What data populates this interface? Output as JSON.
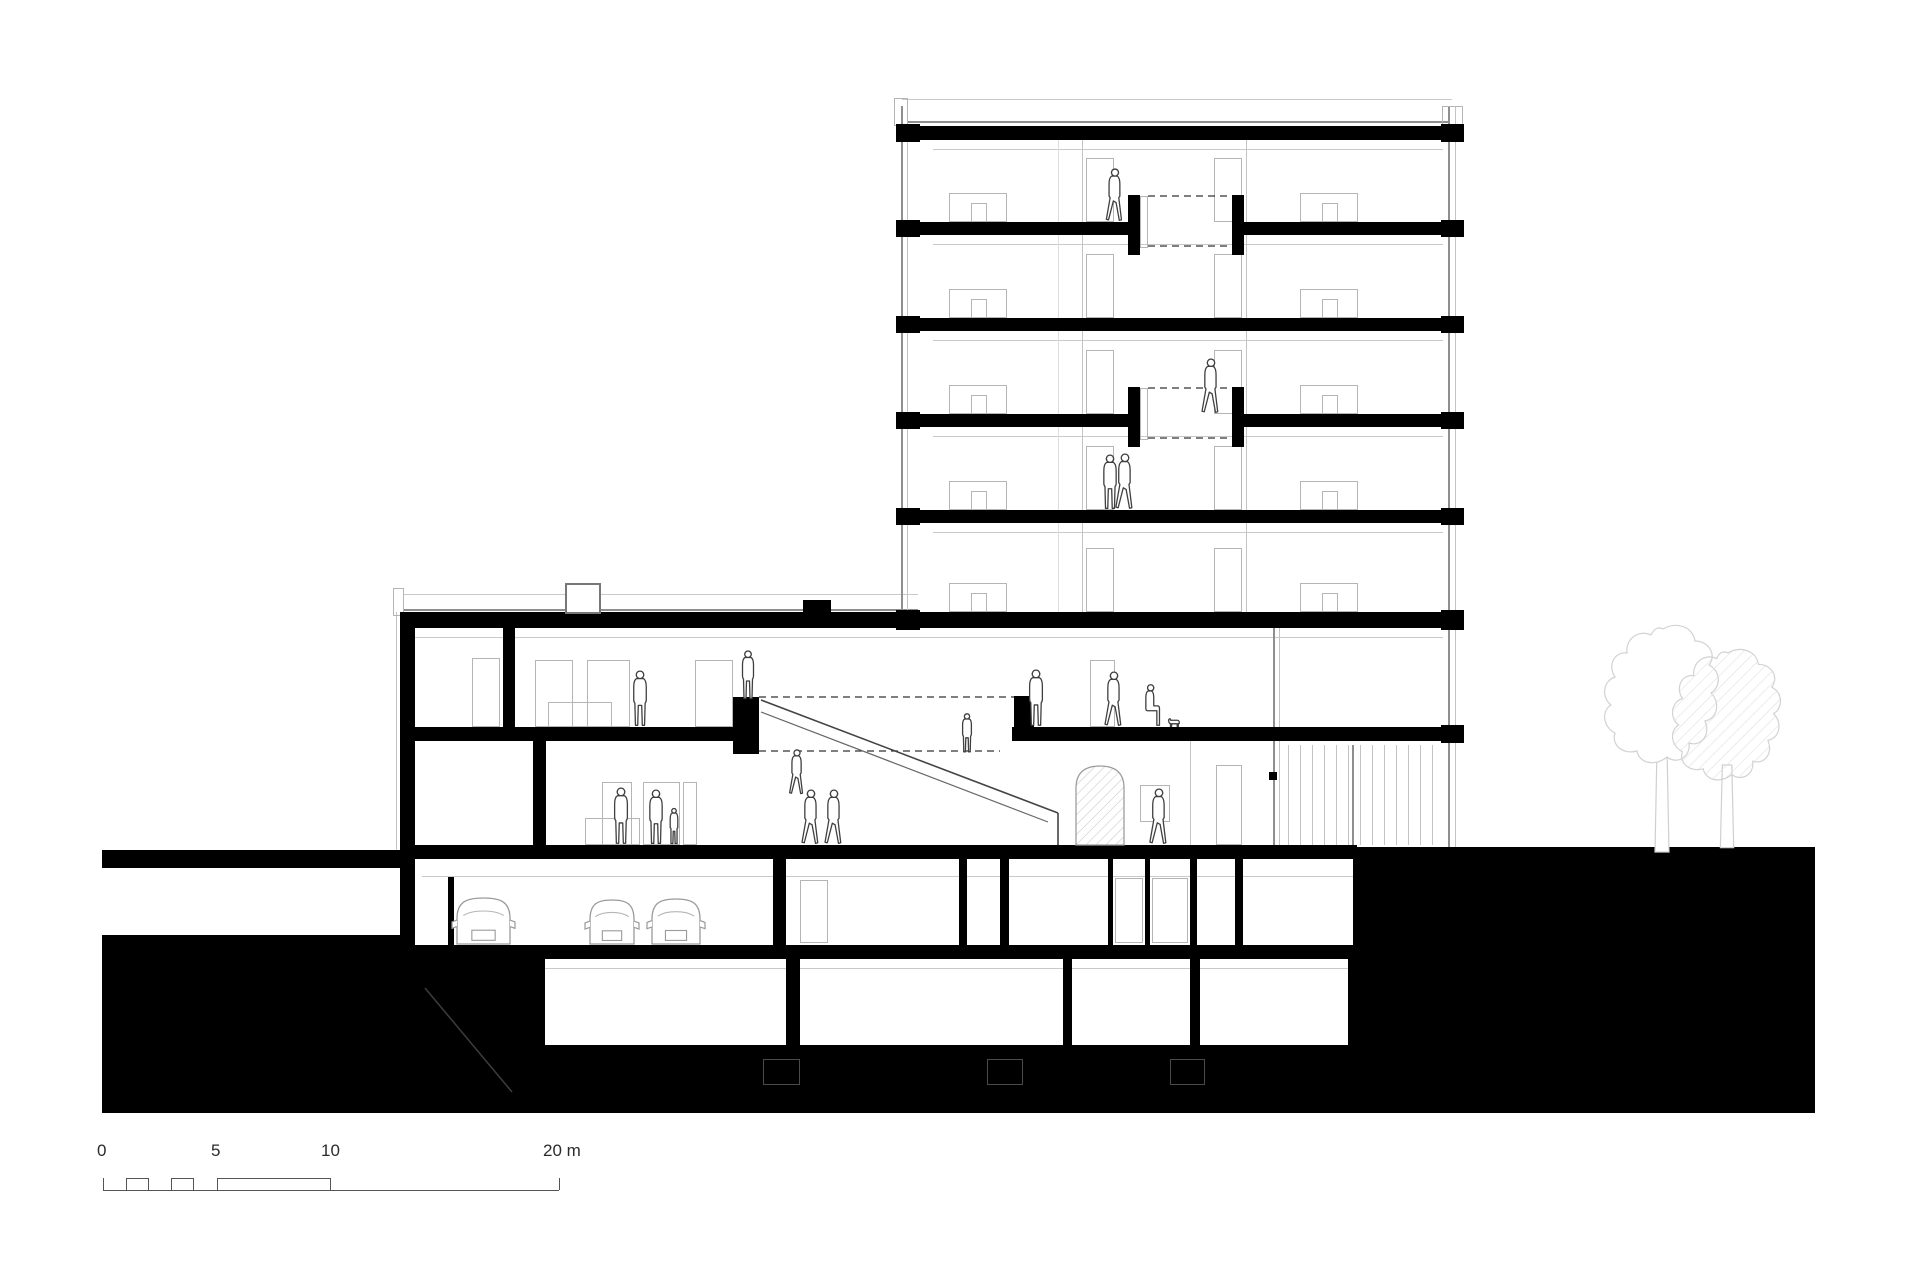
{
  "meta": {
    "drawing_type": "building cross-section",
    "unit": "m"
  },
  "colors": {
    "ink": "#000000",
    "frame_gray": "#b5b5b5",
    "tree_gray": "#d7d7d7",
    "figure_gray": "#3f3f3f"
  },
  "scale_bar": {
    "unit_label": "m",
    "labels": [
      {
        "text": "0",
        "x": 97,
        "y": 1142
      },
      {
        "text": "5",
        "x": 211,
        "y": 1142
      },
      {
        "text": "10",
        "x": 321,
        "y": 1142
      },
      {
        "text": "20 m",
        "x": 543,
        "y": 1142
      }
    ],
    "baseline": {
      "x1": 103,
      "x2": 559,
      "y": 1190
    },
    "teeth": [
      [
        126,
        149
      ],
      [
        171,
        194
      ],
      [
        217,
        331
      ]
    ],
    "tooth_top": 1178,
    "end_ticks": [
      103,
      559
    ]
  },
  "drawing": {
    "rects": [
      {
        "n": "roof-slab",
        "x": 918,
        "y": 126,
        "w": 525,
        "h": 14
      },
      {
        "n": "floor-slab",
        "x": 918,
        "y": 222,
        "w": 210,
        "h": 13
      },
      {
        "n": "floor-slab",
        "x": 1244,
        "y": 222,
        "w": 199,
        "h": 13
      },
      {
        "n": "void-stub",
        "x": 1128,
        "y": 195,
        "w": 12,
        "h": 60
      },
      {
        "n": "void-stub",
        "x": 1232,
        "y": 195,
        "w": 12,
        "h": 60
      },
      {
        "n": "floor-slab",
        "x": 918,
        "y": 318,
        "w": 525,
        "h": 13
      },
      {
        "n": "floor-slab",
        "x": 918,
        "y": 414,
        "w": 210,
        "h": 13
      },
      {
        "n": "floor-slab",
        "x": 1244,
        "y": 414,
        "w": 199,
        "h": 13
      },
      {
        "n": "void-stub",
        "x": 1128,
        "y": 387,
        "w": 12,
        "h": 60
      },
      {
        "n": "void-stub",
        "x": 1232,
        "y": 387,
        "w": 12,
        "h": 60
      },
      {
        "n": "floor-slab",
        "x": 918,
        "y": 510,
        "w": 525,
        "h": 13
      },
      {
        "n": "podium-roof-slab",
        "x": 400,
        "y": 612,
        "w": 1043,
        "h": 16
      },
      {
        "n": "roof-step",
        "x": 803,
        "y": 600,
        "w": 28,
        "h": 14
      },
      {
        "n": "mid-slab",
        "x": 400,
        "y": 727,
        "w": 346,
        "h": 14
      },
      {
        "n": "mid-slab",
        "x": 1012,
        "y": 727,
        "w": 431,
        "h": 14
      },
      {
        "n": "stair-stub",
        "x": 733,
        "y": 697,
        "w": 26,
        "h": 57
      },
      {
        "n": "stair-stub",
        "x": 1014,
        "y": 696,
        "w": 20,
        "h": 45
      },
      {
        "n": "ground-slab",
        "x": 400,
        "y": 845,
        "w": 957,
        "h": 14
      },
      {
        "n": "parking-slab",
        "x": 400,
        "y": 945,
        "w": 968,
        "h": 14
      },
      {
        "n": "basement-slab",
        "x": 530,
        "y": 1045,
        "w": 838,
        "h": 14
      },
      {
        "n": "wall",
        "x": 400,
        "y": 616,
        "w": 15,
        "h": 342
      },
      {
        "n": "wall",
        "x": 503,
        "y": 628,
        "w": 12,
        "h": 113
      },
      {
        "n": "wall",
        "x": 533,
        "y": 741,
        "w": 13,
        "h": 118
      },
      {
        "n": "wall",
        "x": 448,
        "y": 877,
        "w": 6,
        "h": 68
      },
      {
        "n": "wall",
        "x": 773,
        "y": 859,
        "w": 13,
        "h": 86
      },
      {
        "n": "wall",
        "x": 959,
        "y": 859,
        "w": 8,
        "h": 86
      },
      {
        "n": "wall",
        "x": 1000,
        "y": 859,
        "w": 9,
        "h": 86
      },
      {
        "n": "wall",
        "x": 1108,
        "y": 859,
        "w": 5,
        "h": 86
      },
      {
        "n": "wall",
        "x": 1145,
        "y": 859,
        "w": 5,
        "h": 86
      },
      {
        "n": "wall",
        "x": 1190,
        "y": 859,
        "w": 7,
        "h": 86
      },
      {
        "n": "wall",
        "x": 1235,
        "y": 859,
        "w": 8,
        "h": 86
      },
      {
        "n": "wall",
        "x": 1353,
        "y": 859,
        "w": 15,
        "h": 86
      },
      {
        "n": "wall",
        "x": 530,
        "y": 959,
        "w": 15,
        "h": 86
      },
      {
        "n": "wall",
        "x": 786,
        "y": 959,
        "w": 14,
        "h": 86
      },
      {
        "n": "wall",
        "x": 1063,
        "y": 959,
        "w": 9,
        "h": 86
      },
      {
        "n": "wall",
        "x": 1190,
        "y": 959,
        "w": 10,
        "h": 86
      },
      {
        "n": "wall",
        "x": 1348,
        "y": 959,
        "w": 20,
        "h": 86
      },
      {
        "n": "facade-anchor",
        "x": 896,
        "y": 124,
        "w": 24,
        "h": 18
      },
      {
        "n": "facade-anchor",
        "x": 896,
        "y": 220,
        "w": 24,
        "h": 17
      },
      {
        "n": "facade-anchor",
        "x": 896,
        "y": 316,
        "w": 24,
        "h": 17
      },
      {
        "n": "facade-anchor",
        "x": 896,
        "y": 412,
        "w": 24,
        "h": 17
      },
      {
        "n": "facade-anchor",
        "x": 896,
        "y": 508,
        "w": 24,
        "h": 17
      },
      {
        "n": "facade-anchor",
        "x": 896,
        "y": 610,
        "w": 24,
        "h": 20
      },
      {
        "n": "facade-anchor",
        "x": 1441,
        "y": 124,
        "w": 23,
        "h": 18
      },
      {
        "n": "facade-anchor",
        "x": 1441,
        "y": 220,
        "w": 23,
        "h": 17
      },
      {
        "n": "facade-anchor",
        "x": 1441,
        "y": 316,
        "w": 23,
        "h": 17
      },
      {
        "n": "facade-anchor",
        "x": 1441,
        "y": 412,
        "w": 23,
        "h": 17
      },
      {
        "n": "facade-anchor",
        "x": 1441,
        "y": 508,
        "w": 23,
        "h": 17
      },
      {
        "n": "facade-anchor",
        "x": 1441,
        "y": 610,
        "w": 23,
        "h": 20
      },
      {
        "n": "facade-anchor",
        "x": 1441,
        "y": 725,
        "w": 23,
        "h": 18
      },
      {
        "n": "glazing-fitting",
        "x": 1269,
        "y": 772,
        "w": 8,
        "h": 8
      },
      {
        "n": "terrain-surface-left",
        "x": 102,
        "y": 850,
        "w": 298,
        "h": 18
      },
      {
        "n": "terrain-mass-left",
        "x": 102,
        "y": 935,
        "w": 298,
        "h": 178
      },
      {
        "n": "terrain-mass-under-left",
        "x": 400,
        "y": 958,
        "w": 130,
        "h": 155
      },
      {
        "n": "terrain-mass-under-mid",
        "x": 530,
        "y": 1059,
        "w": 838,
        "h": 54
      },
      {
        "n": "terrain-mass-right",
        "x": 1357,
        "y": 847,
        "w": 458,
        "h": 266
      }
    ],
    "tower_floor_bottoms": [
      222,
      318,
      414,
      510,
      612
    ],
    "tower_repeat": {
      "door_left": {
        "x": 1086,
        "w": 28,
        "h": 64
      },
      "door_right": {
        "x": 1214,
        "w": 28,
        "h": 64
      },
      "icon_left": {
        "x": 949,
        "w": 58,
        "h": 29,
        "ix": 971,
        "iw": 16,
        "ih": 19
      },
      "icon_right": {
        "x": 1300,
        "w": 58,
        "h": 29,
        "ix": 1322,
        "iw": 16,
        "ih": 19
      }
    },
    "frames": [
      {
        "n": "void-panel",
        "x": 1140,
        "y": 196,
        "w": 8,
        "h": 52
      },
      {
        "n": "void-panel",
        "x": 1140,
        "y": 388,
        "w": 8,
        "h": 52
      },
      {
        "n": "door-frame",
        "x": 472,
        "y": 658,
        "w": 28,
        "h": 69
      },
      {
        "n": "door-frame",
        "x": 535,
        "y": 660,
        "w": 38,
        "h": 67
      },
      {
        "n": "door-frame",
        "x": 587,
        "y": 660,
        "w": 43,
        "h": 67
      },
      {
        "n": "door-frame",
        "x": 695,
        "y": 660,
        "w": 38,
        "h": 67
      },
      {
        "n": "counter-outline",
        "x": 548,
        "y": 702,
        "w": 64,
        "h": 25
      },
      {
        "n": "door-frame",
        "x": 1090,
        "y": 660,
        "w": 25,
        "h": 67
      },
      {
        "n": "door-frame",
        "x": 1216,
        "y": 765,
        "w": 26,
        "h": 80
      },
      {
        "n": "picture-frame",
        "x": 1140,
        "y": 785,
        "w": 30,
        "h": 37
      },
      {
        "n": "door-frame",
        "x": 602,
        "y": 782,
        "w": 30,
        "h": 63
      },
      {
        "n": "door-frame",
        "x": 643,
        "y": 782,
        "w": 37,
        "h": 63
      },
      {
        "n": "door-frame",
        "x": 683,
        "y": 782,
        "w": 14,
        "h": 63
      },
      {
        "n": "counter-outline",
        "x": 585,
        "y": 818,
        "w": 55,
        "h": 27
      },
      {
        "n": "door-frame",
        "x": 800,
        "y": 880,
        "w": 28,
        "h": 63
      },
      {
        "n": "elevator-door",
        "x": 1115,
        "y": 878,
        "w": 28,
        "h": 65
      },
      {
        "n": "elevator-door",
        "x": 1152,
        "y": 878,
        "w": 36,
        "h": 65
      },
      {
        "n": "parapet-hook",
        "x": 894,
        "y": 98,
        "w": 14,
        "h": 28
      },
      {
        "n": "parapet-hook",
        "x": 1442,
        "y": 106,
        "w": 21,
        "h": 20
      },
      {
        "n": "parapet-hook",
        "x": 393,
        "y": 588,
        "w": 11,
        "h": 28
      }
    ],
    "dark_frames": [
      {
        "n": "foundation-pad",
        "x": 763,
        "y": 1059,
        "w": 37,
        "h": 26
      },
      {
        "n": "foundation-pad",
        "x": 987,
        "y": 1059,
        "w": 36,
        "h": 26
      },
      {
        "n": "foundation-pad",
        "x": 1170,
        "y": 1059,
        "w": 35,
        "h": 26
      }
    ],
    "white_boxes": [
      {
        "n": "roof-skylight",
        "x": 565,
        "y": 583,
        "w": 36,
        "h": 31
      }
    ],
    "hlines": [
      {
        "x1": 902,
        "x2": 1452,
        "y": 99,
        "c": "light"
      },
      {
        "x1": 908,
        "x2": 1448,
        "y": 121,
        "c": "mid"
      },
      {
        "x1": 404,
        "x2": 918,
        "y": 594,
        "c": "light"
      },
      {
        "x1": 404,
        "x2": 918,
        "y": 609,
        "c": "mid"
      },
      {
        "x1": 933,
        "x2": 1443,
        "y": 149,
        "c": "light"
      },
      {
        "x1": 933,
        "x2": 1443,
        "y": 244,
        "c": "light"
      },
      {
        "x1": 933,
        "x2": 1443,
        "y": 340,
        "c": "light"
      },
      {
        "x1": 933,
        "x2": 1443,
        "y": 436,
        "c": "light"
      },
      {
        "x1": 933,
        "x2": 1443,
        "y": 532,
        "c": "light"
      },
      {
        "x1": 414,
        "x2": 1443,
        "y": 637,
        "c": "light"
      },
      {
        "x1": 422,
        "x2": 1353,
        "y": 876,
        "c": "light"
      },
      {
        "x1": 545,
        "x2": 1348,
        "y": 968,
        "c": "light"
      }
    ],
    "vlines": [
      {
        "y1": 106,
        "y2": 612,
        "x": 901,
        "c": "mid"
      },
      {
        "y1": 106,
        "y2": 612,
        "x": 907,
        "c": "light"
      },
      {
        "y1": 106,
        "y2": 847,
        "x": 1448,
        "c": "mid"
      },
      {
        "y1": 106,
        "y2": 847,
        "x": 1455,
        "c": "light"
      },
      {
        "y1": 140,
        "y2": 612,
        "x": 1058,
        "c": "faint"
      },
      {
        "y1": 140,
        "y2": 612,
        "x": 1082,
        "c": "light"
      },
      {
        "y1": 140,
        "y2": 612,
        "x": 1246,
        "c": "light"
      },
      {
        "y1": 628,
        "y2": 845,
        "x": 1273,
        "c": "mid"
      },
      {
        "y1": 628,
        "y2": 845,
        "x": 1279,
        "c": "light"
      },
      {
        "y1": 745,
        "y2": 845,
        "x": 1352,
        "c": "mid"
      },
      {
        "y1": 612,
        "y2": 850,
        "x": 396,
        "c": "light"
      },
      {
        "y1": 741,
        "y2": 845,
        "x": 1190,
        "c": "light"
      }
    ],
    "louvers": {
      "x1": 1288,
      "x2": 1440,
      "step": 12,
      "y1": 745,
      "y2": 845
    },
    "dashes": [
      {
        "x1": 1148,
        "y1": 196,
        "x2": 1232,
        "y2": 196
      },
      {
        "x1": 1148,
        "y1": 246,
        "x2": 1232,
        "y2": 246
      },
      {
        "x1": 1148,
        "y1": 388,
        "x2": 1232,
        "y2": 388
      },
      {
        "x1": 1148,
        "y1": 438,
        "x2": 1232,
        "y2": 438
      },
      {
        "x1": 759,
        "y1": 697,
        "x2": 1014,
        "y2": 697
      },
      {
        "x1": 759,
        "y1": 751,
        "x2": 1000,
        "y2": 751
      }
    ],
    "diagonals": [
      {
        "n": "stair-stringer",
        "x1": 761,
        "y1": 700,
        "x2": 1058,
        "y2": 813,
        "c": "#444",
        "w": 1.6
      },
      {
        "n": "stair-rail",
        "x1": 761,
        "y1": 712,
        "x2": 1048,
        "y2": 822,
        "c": "#666",
        "w": 1.2
      },
      {
        "n": "stair-edge",
        "x1": 1058,
        "y1": 813,
        "x2": 1058,
        "y2": 845,
        "c": "#444",
        "w": 1.6
      },
      {
        "n": "ramp-line",
        "x1": 425,
        "y1": 988,
        "x2": 512,
        "y2": 1092,
        "c": "#3d3d3d",
        "w": 1.5
      }
    ],
    "figures": [
      {
        "v": "walk",
        "x": 1115,
        "y": 222,
        "h": 54
      },
      {
        "v": "walk",
        "x": 1211,
        "y": 414,
        "h": 56
      },
      {
        "v": "stand",
        "x": 1110,
        "y": 510,
        "h": 56
      },
      {
        "v": "walk",
        "x": 1125,
        "y": 510,
        "h": 57
      },
      {
        "v": "stand",
        "x": 640,
        "y": 727,
        "h": 57
      },
      {
        "v": "stand",
        "x": 748,
        "y": 700,
        "h": 50
      },
      {
        "v": "stand",
        "x": 1036,
        "y": 727,
        "h": 58
      },
      {
        "v": "walk",
        "x": 1114,
        "y": 727,
        "h": 56
      },
      {
        "v": "seat",
        "x": 1152,
        "y": 727,
        "h": 44
      },
      {
        "v": "dog",
        "x": 1174,
        "y": 727,
        "h": 16
      },
      {
        "v": "stand",
        "x": 621,
        "y": 845,
        "h": 58
      },
      {
        "v": "stand",
        "x": 656,
        "y": 845,
        "h": 56
      },
      {
        "v": "child",
        "x": 674,
        "y": 845,
        "h": 38
      },
      {
        "v": "walk",
        "x": 811,
        "y": 845,
        "h": 56
      },
      {
        "v": "walk",
        "x": 834,
        "y": 845,
        "h": 56
      },
      {
        "v": "walk",
        "x": 1159,
        "y": 845,
        "h": 57
      },
      {
        "v": "walk",
        "x": 797,
        "y": 795,
        "h": 46
      },
      {
        "v": "stand",
        "x": 967,
        "y": 753,
        "h": 40
      }
    ],
    "cars": [
      {
        "x": 457,
        "w": 53,
        "h": 46,
        "yb": 944
      },
      {
        "x": 590,
        "w": 44,
        "h": 44,
        "yb": 944
      },
      {
        "x": 652,
        "w": 48,
        "h": 45,
        "yb": 944
      }
    ],
    "trees": [
      {
        "type": "outline",
        "x": 1663,
        "y": 707,
        "s": 1.0,
        "trunk": 145
      },
      {
        "type": "hatch",
        "x": 1728,
        "y": 727,
        "s": 0.95,
        "trunk": 127
      }
    ],
    "stove": {
      "x": 1076,
      "y": 845,
      "w": 48,
      "h": 79
    }
  }
}
